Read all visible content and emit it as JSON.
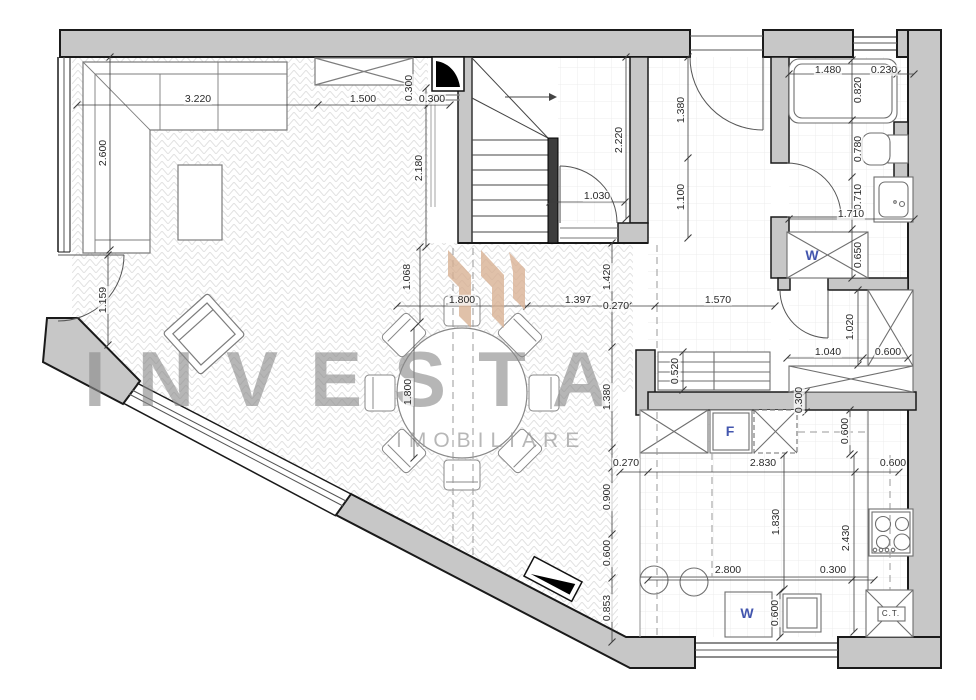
{
  "watermark": {
    "title": "INVESTA",
    "subtitle": "IMOBILIARE",
    "title_color": "#8a8a8a",
    "subtitle_color": "#9a9a9a",
    "logo_color": "#d8b092"
  },
  "colors": {
    "wall_fill": "#c7c7c7",
    "wall_stroke": "#1a1a1a",
    "appliance_label_blue": "#4356ae"
  },
  "labels": [
    {
      "text": "3.220",
      "x": 198,
      "y": 99
    },
    {
      "text": "1.500",
      "x": 363,
      "y": 99
    },
    {
      "text": "0.300",
      "x": 409,
      "y": 88,
      "rot": 1
    },
    {
      "text": "0.300",
      "x": 432,
      "y": 99
    },
    {
      "text": "2.600",
      "x": 103,
      "y": 153,
      "rot": 1
    },
    {
      "text": "1.159",
      "x": 103,
      "y": 300,
      "rot": 1
    },
    {
      "text": "2.180",
      "x": 419,
      "y": 168,
      "rot": 1
    },
    {
      "text": "1.068",
      "x": 407,
      "y": 277,
      "rot": 1
    },
    {
      "text": "2.220",
      "x": 619,
      "y": 140,
      "rot": 1
    },
    {
      "text": "1.030",
      "x": 597,
      "y": 196
    },
    {
      "text": "1.380",
      "x": 681,
      "y": 110,
      "rot": 1
    },
    {
      "text": "1.100",
      "x": 681,
      "y": 197,
      "rot": 1
    },
    {
      "text": "1.480",
      "x": 828,
      "y": 70
    },
    {
      "text": "0.230",
      "x": 884,
      "y": 70
    },
    {
      "text": "0.820",
      "x": 858,
      "y": 90,
      "rot": 1
    },
    {
      "text": "0.780",
      "x": 858,
      "y": 149,
      "rot": 1
    },
    {
      "text": "0.710",
      "x": 858,
      "y": 197,
      "rot": 1
    },
    {
      "text": "1.710",
      "x": 851,
      "y": 214
    },
    {
      "text": "0.650",
      "x": 858,
      "y": 255,
      "rot": 1
    },
    {
      "text": "W",
      "x": 812,
      "y": 255,
      "cls": "app"
    },
    {
      "text": "1.800",
      "x": 462,
      "y": 300
    },
    {
      "text": "1.397",
      "x": 578,
      "y": 300
    },
    {
      "text": "0.270",
      "x": 616,
      "y": 306
    },
    {
      "text": "1.570",
      "x": 718,
      "y": 300
    },
    {
      "text": "1.420",
      "x": 607,
      "y": 277,
      "rot": 1
    },
    {
      "text": "1.800",
      "x": 408,
      "y": 392,
      "rot": 1
    },
    {
      "text": "1.380",
      "x": 607,
      "y": 397,
      "rot": 1
    },
    {
      "text": "0.520",
      "x": 675,
      "y": 371,
      "rot": 1
    },
    {
      "text": "1.020",
      "x": 850,
      "y": 327,
      "rot": 1
    },
    {
      "text": "1.040",
      "x": 828,
      "y": 352
    },
    {
      "text": "0.600",
      "x": 888,
      "y": 352
    },
    {
      "text": "0.300",
      "x": 799,
      "y": 400,
      "rot": 1
    },
    {
      "text": "F",
      "x": 730,
      "y": 431,
      "cls": "app"
    },
    {
      "text": "0.600",
      "x": 845,
      "y": 431,
      "rot": 1
    },
    {
      "text": "0.270",
      "x": 626,
      "y": 463
    },
    {
      "text": "2.830",
      "x": 763,
      "y": 463
    },
    {
      "text": "0.600",
      "x": 893,
      "y": 463
    },
    {
      "text": "0.900",
      "x": 607,
      "y": 497,
      "rot": 1
    },
    {
      "text": "1.830",
      "x": 776,
      "y": 522,
      "rot": 1
    },
    {
      "text": "2.430",
      "x": 846,
      "y": 538,
      "rot": 1
    },
    {
      "text": "0.600",
      "x": 607,
      "y": 553,
      "rot": 1
    },
    {
      "text": "2.800",
      "x": 728,
      "y": 570
    },
    {
      "text": "0.300",
      "x": 833,
      "y": 570
    },
    {
      "text": "0.853",
      "x": 607,
      "y": 608,
      "rot": 1
    },
    {
      "text": "W",
      "x": 747,
      "y": 613,
      "cls": "app"
    },
    {
      "text": "0.600",
      "x": 775,
      "y": 613,
      "rot": 1
    },
    {
      "text": "C.T.",
      "x": 891,
      "y": 614,
      "cls": "ct"
    }
  ]
}
